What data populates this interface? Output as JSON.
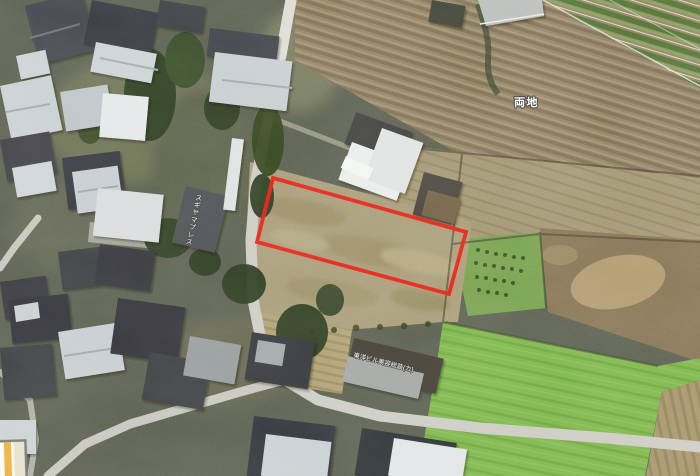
{
  "map": {
    "view_type": "satellite",
    "labels": {
      "district": "両地",
      "press_roof": "スギヤマプレス",
      "company_roof": "東洋ビル美容総装(カ)"
    },
    "parcel": {
      "points": "273,178 466,232 449,294 257,242",
      "outline_color": "#e8211a"
    },
    "inset": {
      "bg_color": "#f2eedb",
      "road_color": "#f0a93c"
    }
  }
}
